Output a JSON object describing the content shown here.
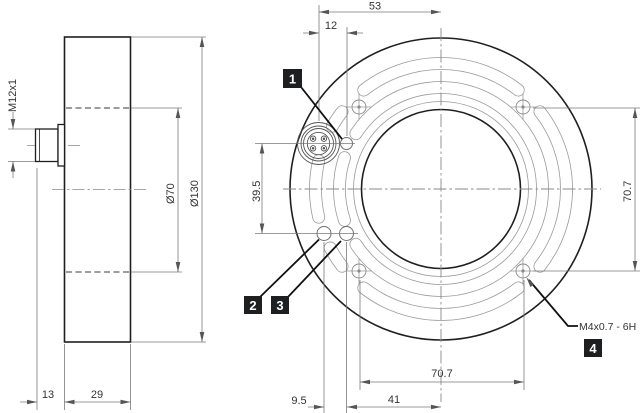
{
  "drawing": {
    "side_view": {
      "thread_label": "M12x1",
      "outer_diameter": "Ø130",
      "bore_diameter": "Ø70",
      "connector_length": "13",
      "body_depth": "29"
    },
    "front_view": {
      "connector_offset": "53",
      "pin_offset": "12",
      "connector_to_pin_vertical": "39.5",
      "mount_hole_spacing_vertical": "70.7",
      "mount_hole_spacing_horizontal": "70.7",
      "pin_to_center": "41",
      "pin_spacing": "9.5",
      "mount_thread_spec": "M4x0.7 - 6H"
    },
    "callouts": [
      {
        "id": "1"
      },
      {
        "id": "2"
      },
      {
        "id": "3"
      },
      {
        "id": "4"
      }
    ]
  }
}
